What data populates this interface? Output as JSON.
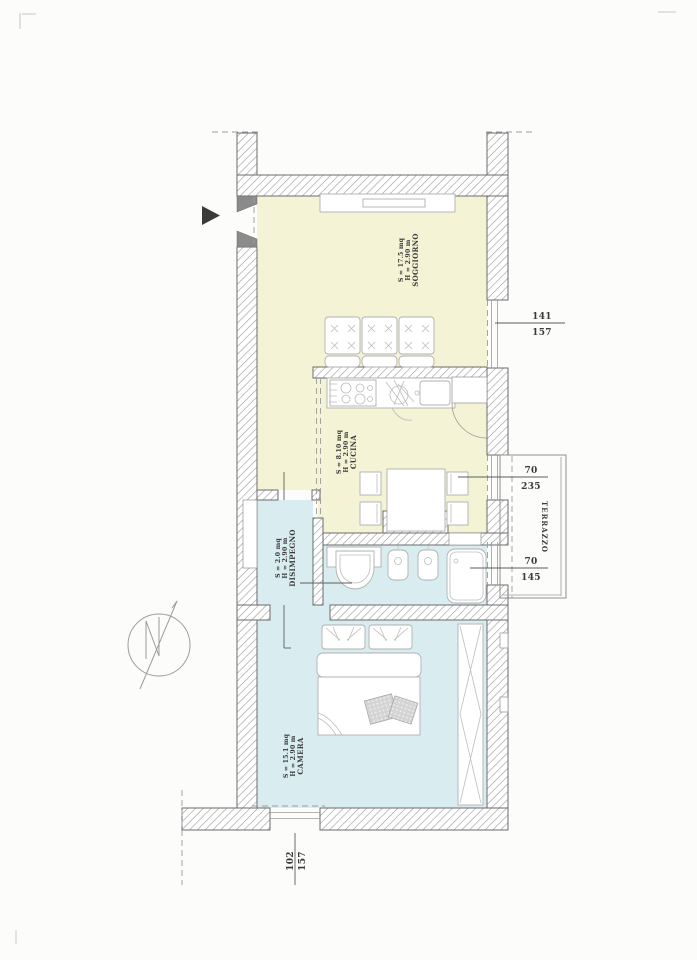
{
  "plan": {
    "rooms": {
      "soggiorno": {
        "name": "SOGGIORNO",
        "height": "H = 2.90 m",
        "area": "S = 17.5 mq"
      },
      "cucina": {
        "name": "CUCINA",
        "height": "H = 2.90 m",
        "area": "S = 8.10 mq"
      },
      "disimpegno": {
        "name": "DISIMPEGNO",
        "height": "H = 2.90 m",
        "area": "S = 2.0 mq"
      },
      "camera": {
        "name": "CAMERA",
        "height": "H = 2.90 m",
        "area": "S = 15.1 mq"
      },
      "terrazzo": {
        "name": "TERRAZZO"
      }
    },
    "openings": {
      "soggiorno_window": {
        "width": "141",
        "height": "157"
      },
      "terrace_door": {
        "width": "70",
        "height": "235"
      },
      "terrace_window": {
        "width": "70",
        "height": "145"
      },
      "camera_window": {
        "width": "102",
        "height": "157"
      }
    },
    "colors": {
      "living_zone": "#f5f3d5",
      "sleeping_zone": "#d9edf0",
      "wall_line": "#6b6b6b",
      "hatch": "#9a9a9a"
    }
  }
}
